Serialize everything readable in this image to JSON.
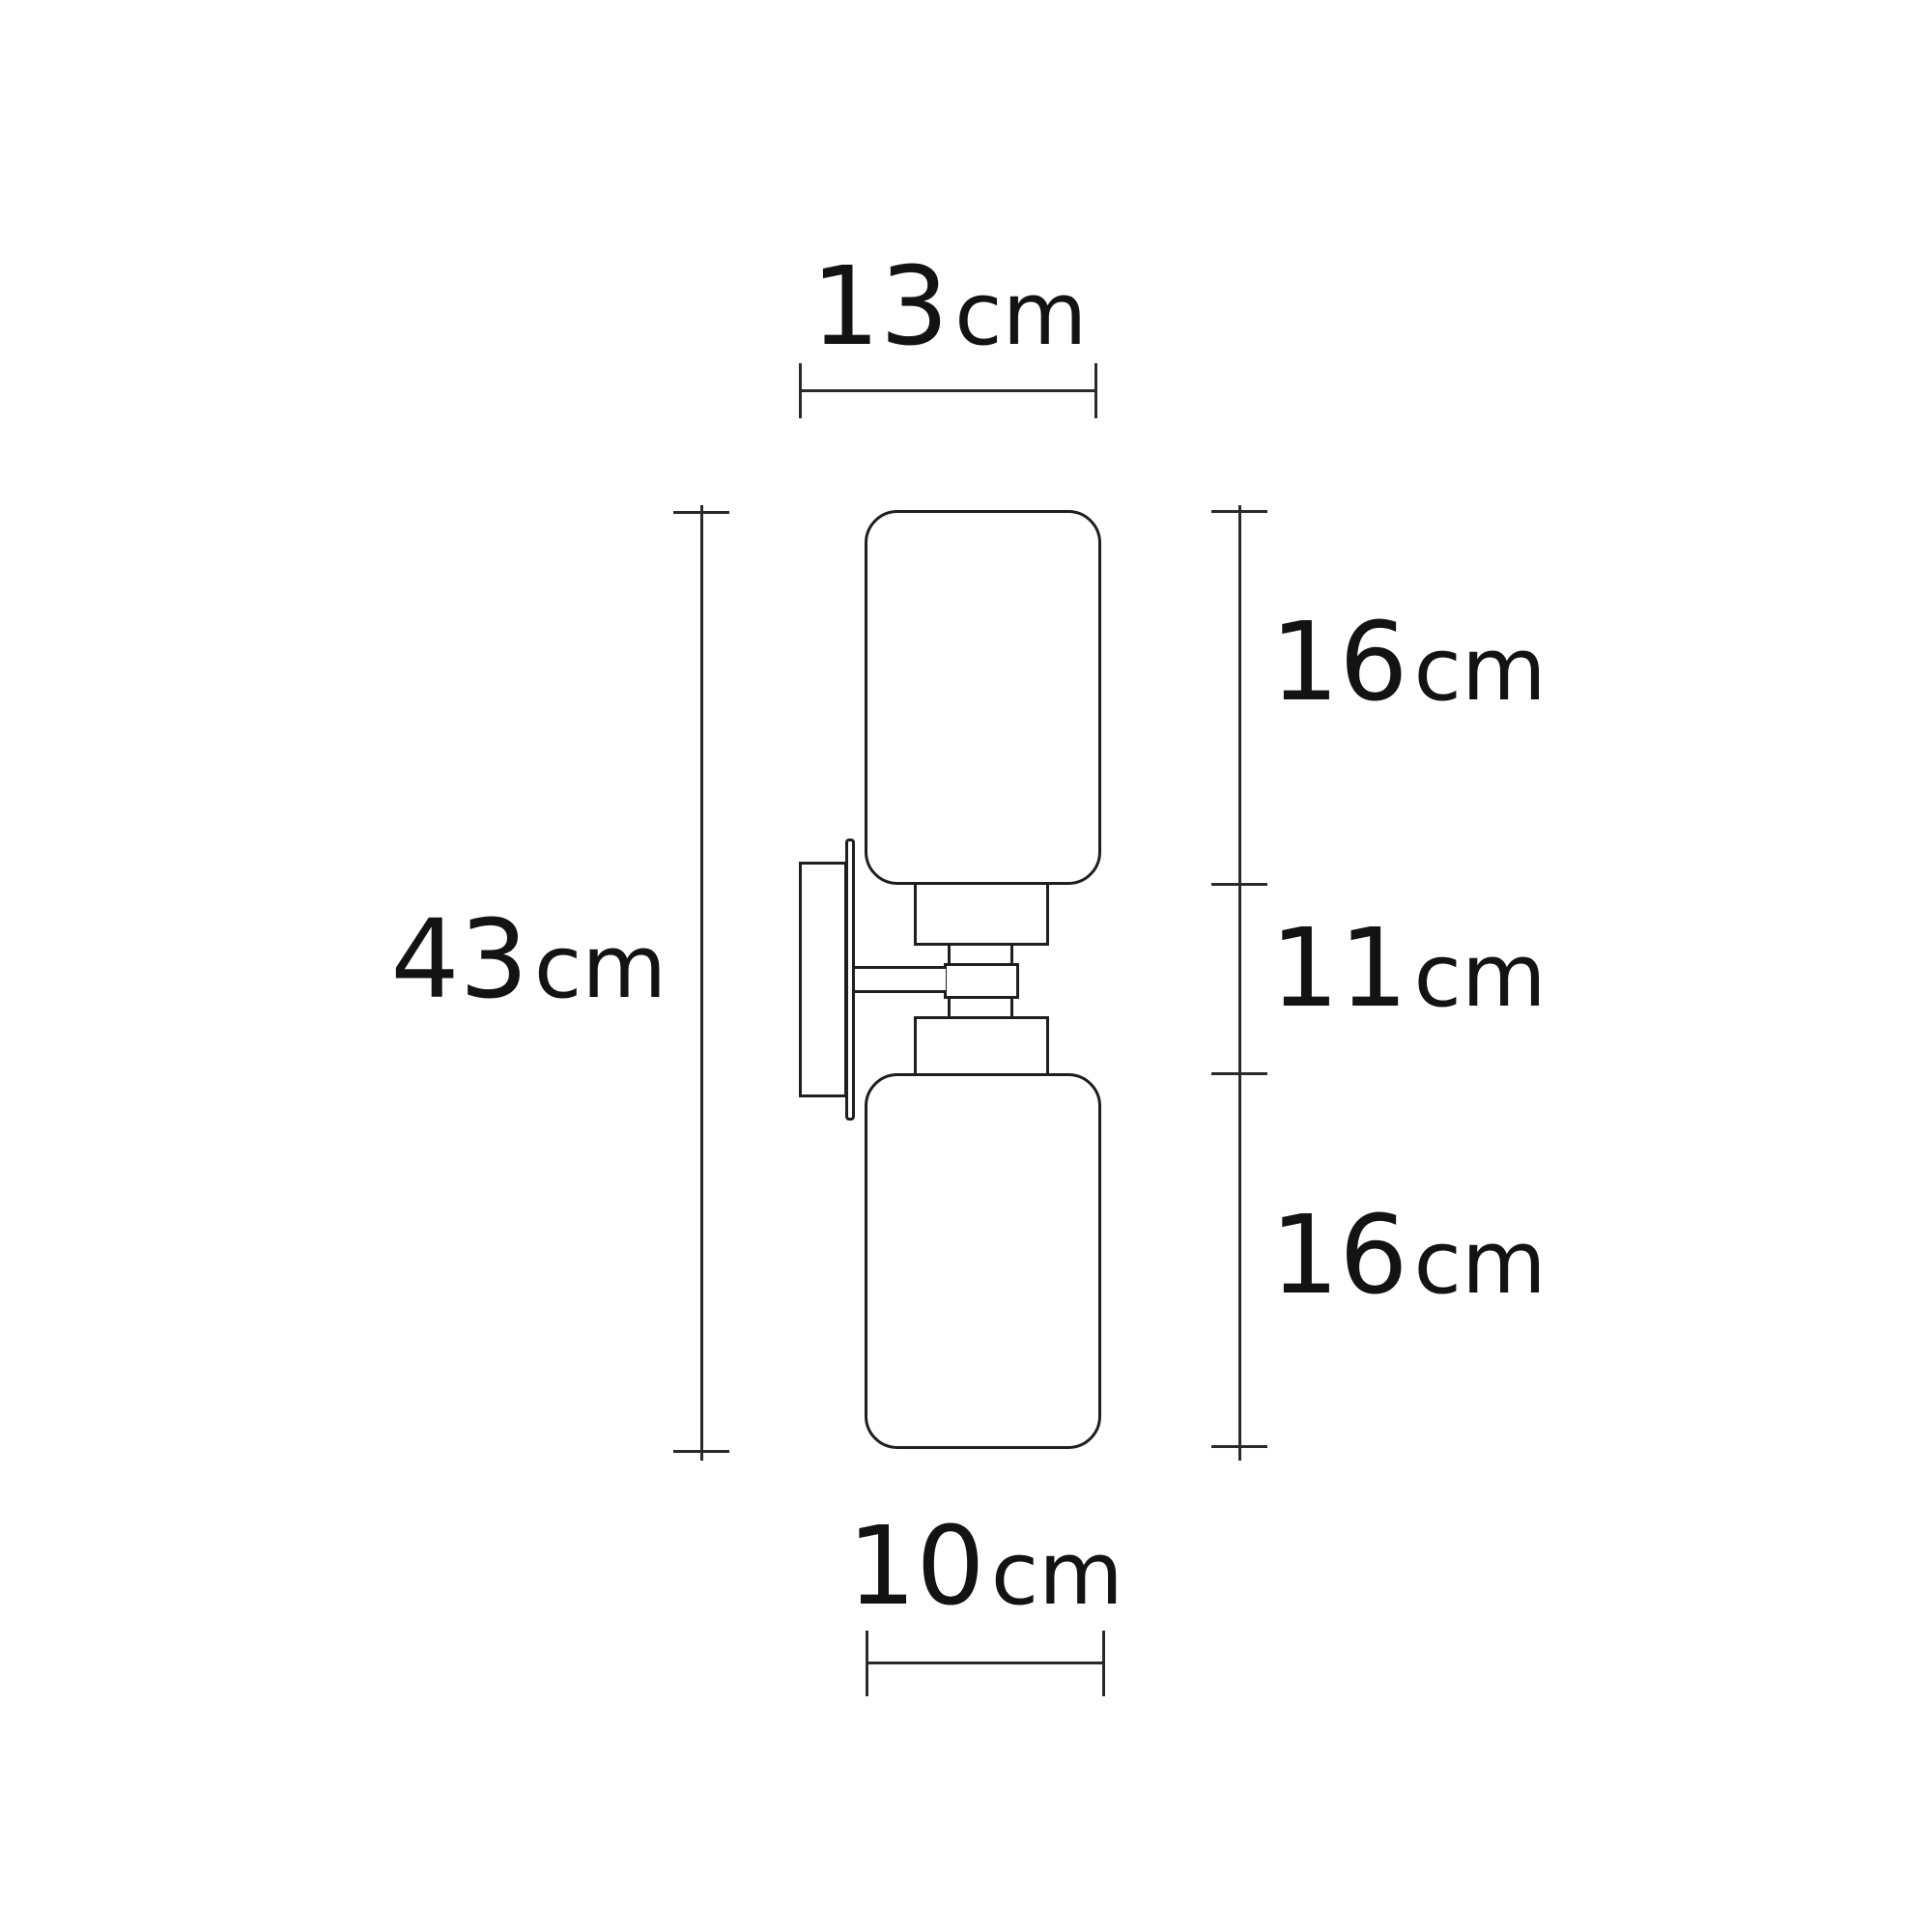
{
  "diagram": {
    "type": "product-dimension-drawing",
    "dimensions": {
      "top_width": {
        "value": "13",
        "unit": "cm"
      },
      "total_height": {
        "value": "43",
        "unit": "cm"
      },
      "upper_shade_height": {
        "value": "16",
        "unit": "cm"
      },
      "middle_height": {
        "value": "11",
        "unit": "cm"
      },
      "lower_shade_height": {
        "value": "16",
        "unit": "cm"
      },
      "bottom_width": {
        "value": "10",
        "unit": "cm"
      }
    },
    "colors": {
      "background": "#ffffff",
      "outline": "#1f1f1f",
      "dimension_line": "#2a2a2a",
      "text": "#131313"
    }
  }
}
